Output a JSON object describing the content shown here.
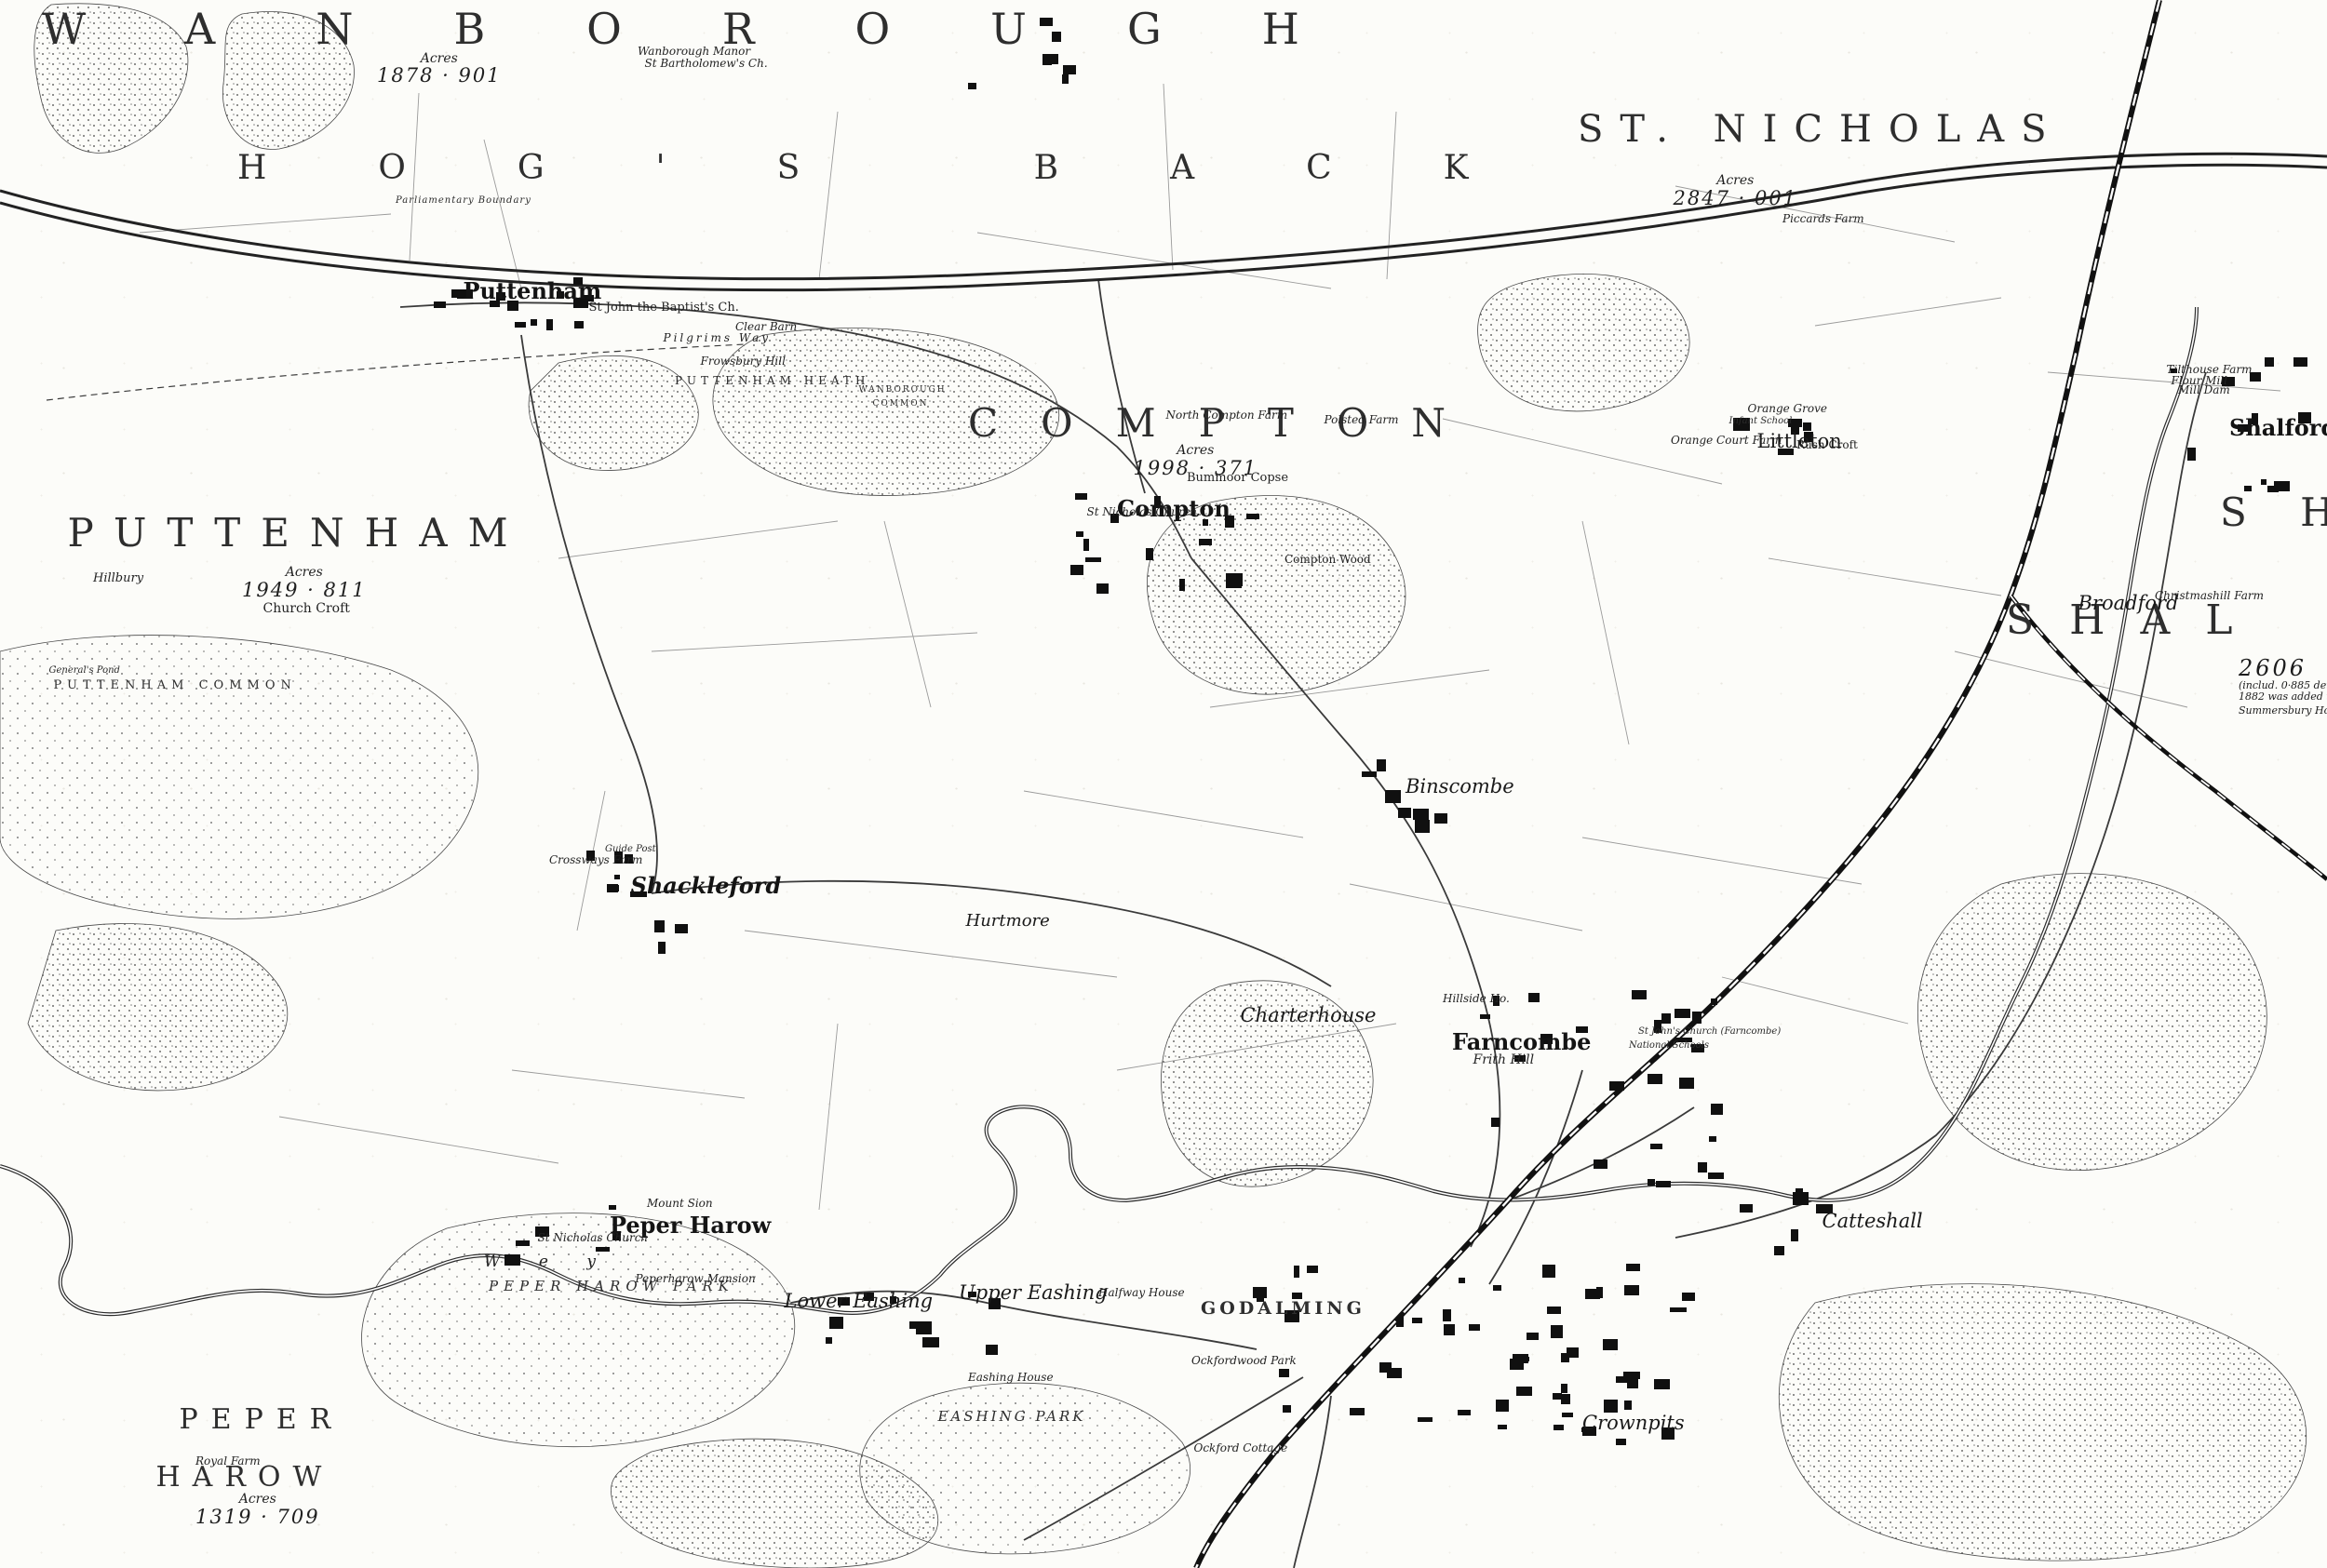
{
  "parish": {
    "wanborough": "WANBOROUGH",
    "st_nicholas": "ST. NICHOLAS",
    "hogs_back": "HOG'S BACK",
    "puttenham": "PUTTENHAM",
    "compton": "COMPTON",
    "shalford_partial": "SHAL",
    "sh_fragment": "S H",
    "peper": "PEPER",
    "harow": "HAROW",
    "godalming": "GODALMING"
  },
  "commons": {
    "puttenham_common": "PUTTENHAM COMMON",
    "puttenham_heath": "PUTTENHAM HEATH",
    "wanborough_common_1": "WANBOROUGH",
    "wanborough_common_2": "COMMON",
    "peper_harow_park": "PEPER HAROW PARK",
    "eashing_park": "EASHING PARK"
  },
  "villages": {
    "puttenham": "Puttenham",
    "compton": "Compton",
    "littleton": "Littleton",
    "shalford": "Shalford",
    "shackleford": "Shackleford",
    "binscombe": "Binscombe",
    "farncombe": "Farncombe",
    "frith_hill": "Frith Hill",
    "peper_harow": "Peper Harow",
    "lower_eashing": "Lower Eashing",
    "upper_eashing": "Upper Eashing",
    "broadford": "Broadford",
    "catteshall": "Catteshall",
    "crownpits": "Crownpits",
    "charterhouse": "Charterhouse",
    "hurtmore": "Hurtmore"
  },
  "acreage": {
    "wanborough": {
      "label": "Acres",
      "value": "1878 · 901"
    },
    "st_nicholas": {
      "label": "Acres",
      "value": "2847 · 001"
    },
    "puttenham": {
      "label": "Acres",
      "value": "1949 · 811"
    },
    "compton": {
      "label": "Acres",
      "value": "1998 · 371"
    },
    "peper_harow": {
      "label": "Acres",
      "value": "1319 · 709"
    },
    "shalford_note": {
      "value": "2606",
      "line2": "(includ. 0·885 det.)",
      "line3": "1882 was added to the",
      "line4": "Summersbury House"
    }
  },
  "features": {
    "church_croft": "Church Croft",
    "wanborough_manor": "Wanborough Manor",
    "st_bartholomews": "St Bartholomew's Ch.",
    "st_john_baptist": "St John the Baptist's Ch.",
    "clear_barn": "Clear Barn",
    "frowsbury_hill": "Frowsbury Hill",
    "pilgrims_way": "Pilgrims Way",
    "parliamentary_boundary": "Parliamentary Boundary",
    "hillbury": "Hillbury",
    "generals_pond": "General's Pond",
    "north_compton_farm": "North Compton Farm",
    "polsted_farm": "Polsted Farm",
    "bummoor_copse": "Bummoor Copse",
    "st_nicholas_church_compton": "St Nicholas Church",
    "compton_wood": "Compton Wood",
    "orange_grove": "Orange Grove",
    "infant_school": "Infant School",
    "orange_court_farm": "Orange Court Farm",
    "rush_croft": "Rush Croft",
    "piccards_farm": "Piccards Farm",
    "tilthouse_farm": "Tilthouse Farm",
    "flour_mill": "Flour Mill",
    "mill_dam": "Mill Dam",
    "christmashill_farm": "Christmashill Farm",
    "crossways_farm": "Crossways Farm",
    "guide_post": "Guide Post",
    "halfway_house": "Halfway House",
    "eashing_house": "Eashing House",
    "ockford_cottage": "Ockford Cottage",
    "ockfordwood_park": "Ockfordwood Park",
    "royal_farm": "Royal Farm",
    "peperharow_mansion": "Peperharow Mansion",
    "st_nicholas_church_peper": "St Nicholas Church",
    "mount_sion": "Mount Sion",
    "wey": "W e y",
    "hillside_ho": "Hillside Ho.",
    "st_johns_farncombe": "St John's Church (Farncombe)",
    "national_schools": "National Schools"
  }
}
